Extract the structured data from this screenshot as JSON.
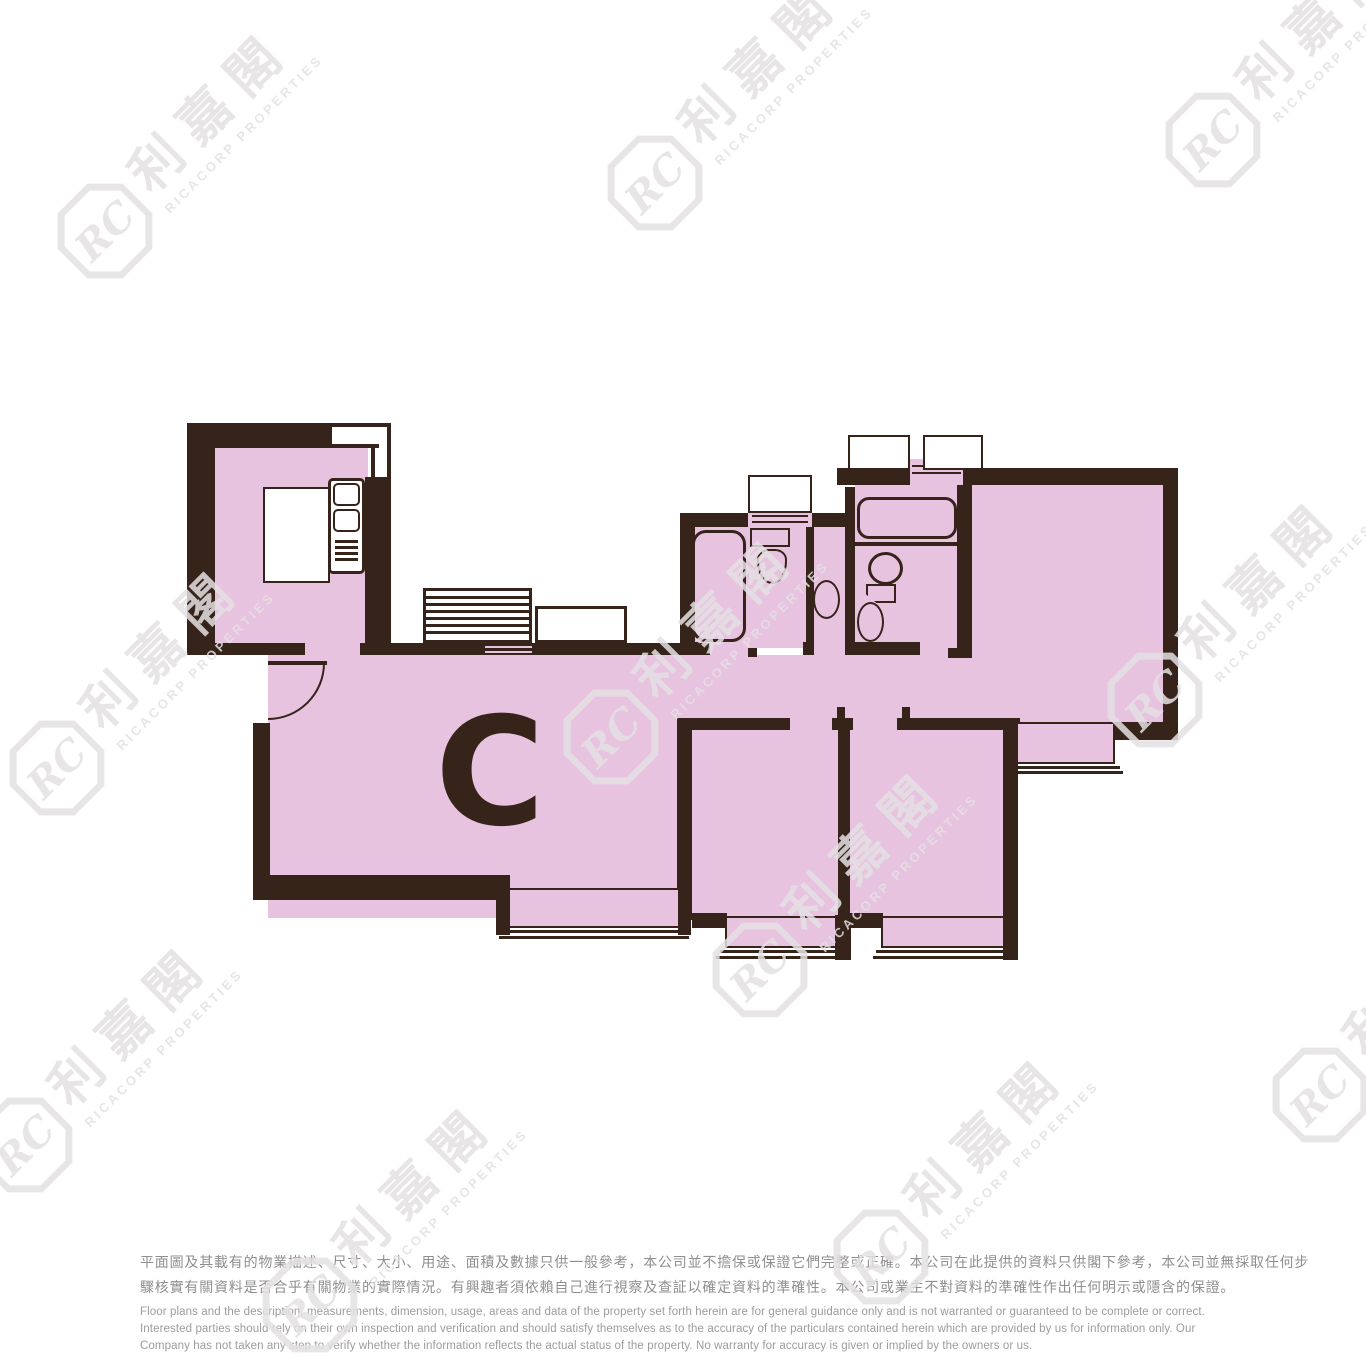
{
  "page": {
    "width": 1366,
    "height": 1366,
    "background": "#ffffff"
  },
  "unit_label": "C",
  "watermark": {
    "monogram": "RC",
    "zh": "利嘉閣",
    "en": "RICACORP PROPERTIES"
  },
  "colors": {
    "floor_pink": "#e7c3e0",
    "wall_dark": "#36241b",
    "watermark_gray": "#e5e2e4",
    "disclaimer_zh_text": "#8f8f8f",
    "disclaimer_en_text": "#9c9c9c"
  },
  "fixtures": [
    "entrance-door",
    "kitchen-counter",
    "kitchen-sink-unit",
    "utility-louver",
    "utility-platform",
    "bathtub-left",
    "toilet-left",
    "washbasin-left",
    "bathtub-right",
    "toilet-right",
    "washbasin-right",
    "window-toilet",
    "window-bath-1",
    "window-bath-2",
    "bay-window-living",
    "bay-window-bedroom-1",
    "bay-window-bedroom-2",
    "bay-window-master"
  ],
  "disclaimer": {
    "zh_lines": [
      "平面圖及其載有的物業描述、尺寸、大小、用途、面積及數據只供一般參考，本公司並不擔保或保證它們完整或正確。本公司在此提供的資料只供閣下參考，本公司並無採取任何步",
      "驟核實有關資料是否合乎有關物業的實際情況。有興趣者須依賴自己進行視察及查証以確定資料的準確性。本公司或業主不對資料的準確性作出任何明示或隱含的保證。"
    ],
    "en_lines": [
      "Floor plans and the description, measurements, dimension, usage, areas and data of the property set forth herein are for general guidance only and is not warranted or guaranteed to be complete or correct.",
      "Interested parties should rely on their own inspection and verification and should satisfy themselves as to the accuracy of the particulars contained herein which are provided by us for information only.  Our",
      "Company has not taken any step to verify whether the information reflects the actual status of the property.  No warranty for accuracy is given or implied by the owners or us."
    ]
  }
}
